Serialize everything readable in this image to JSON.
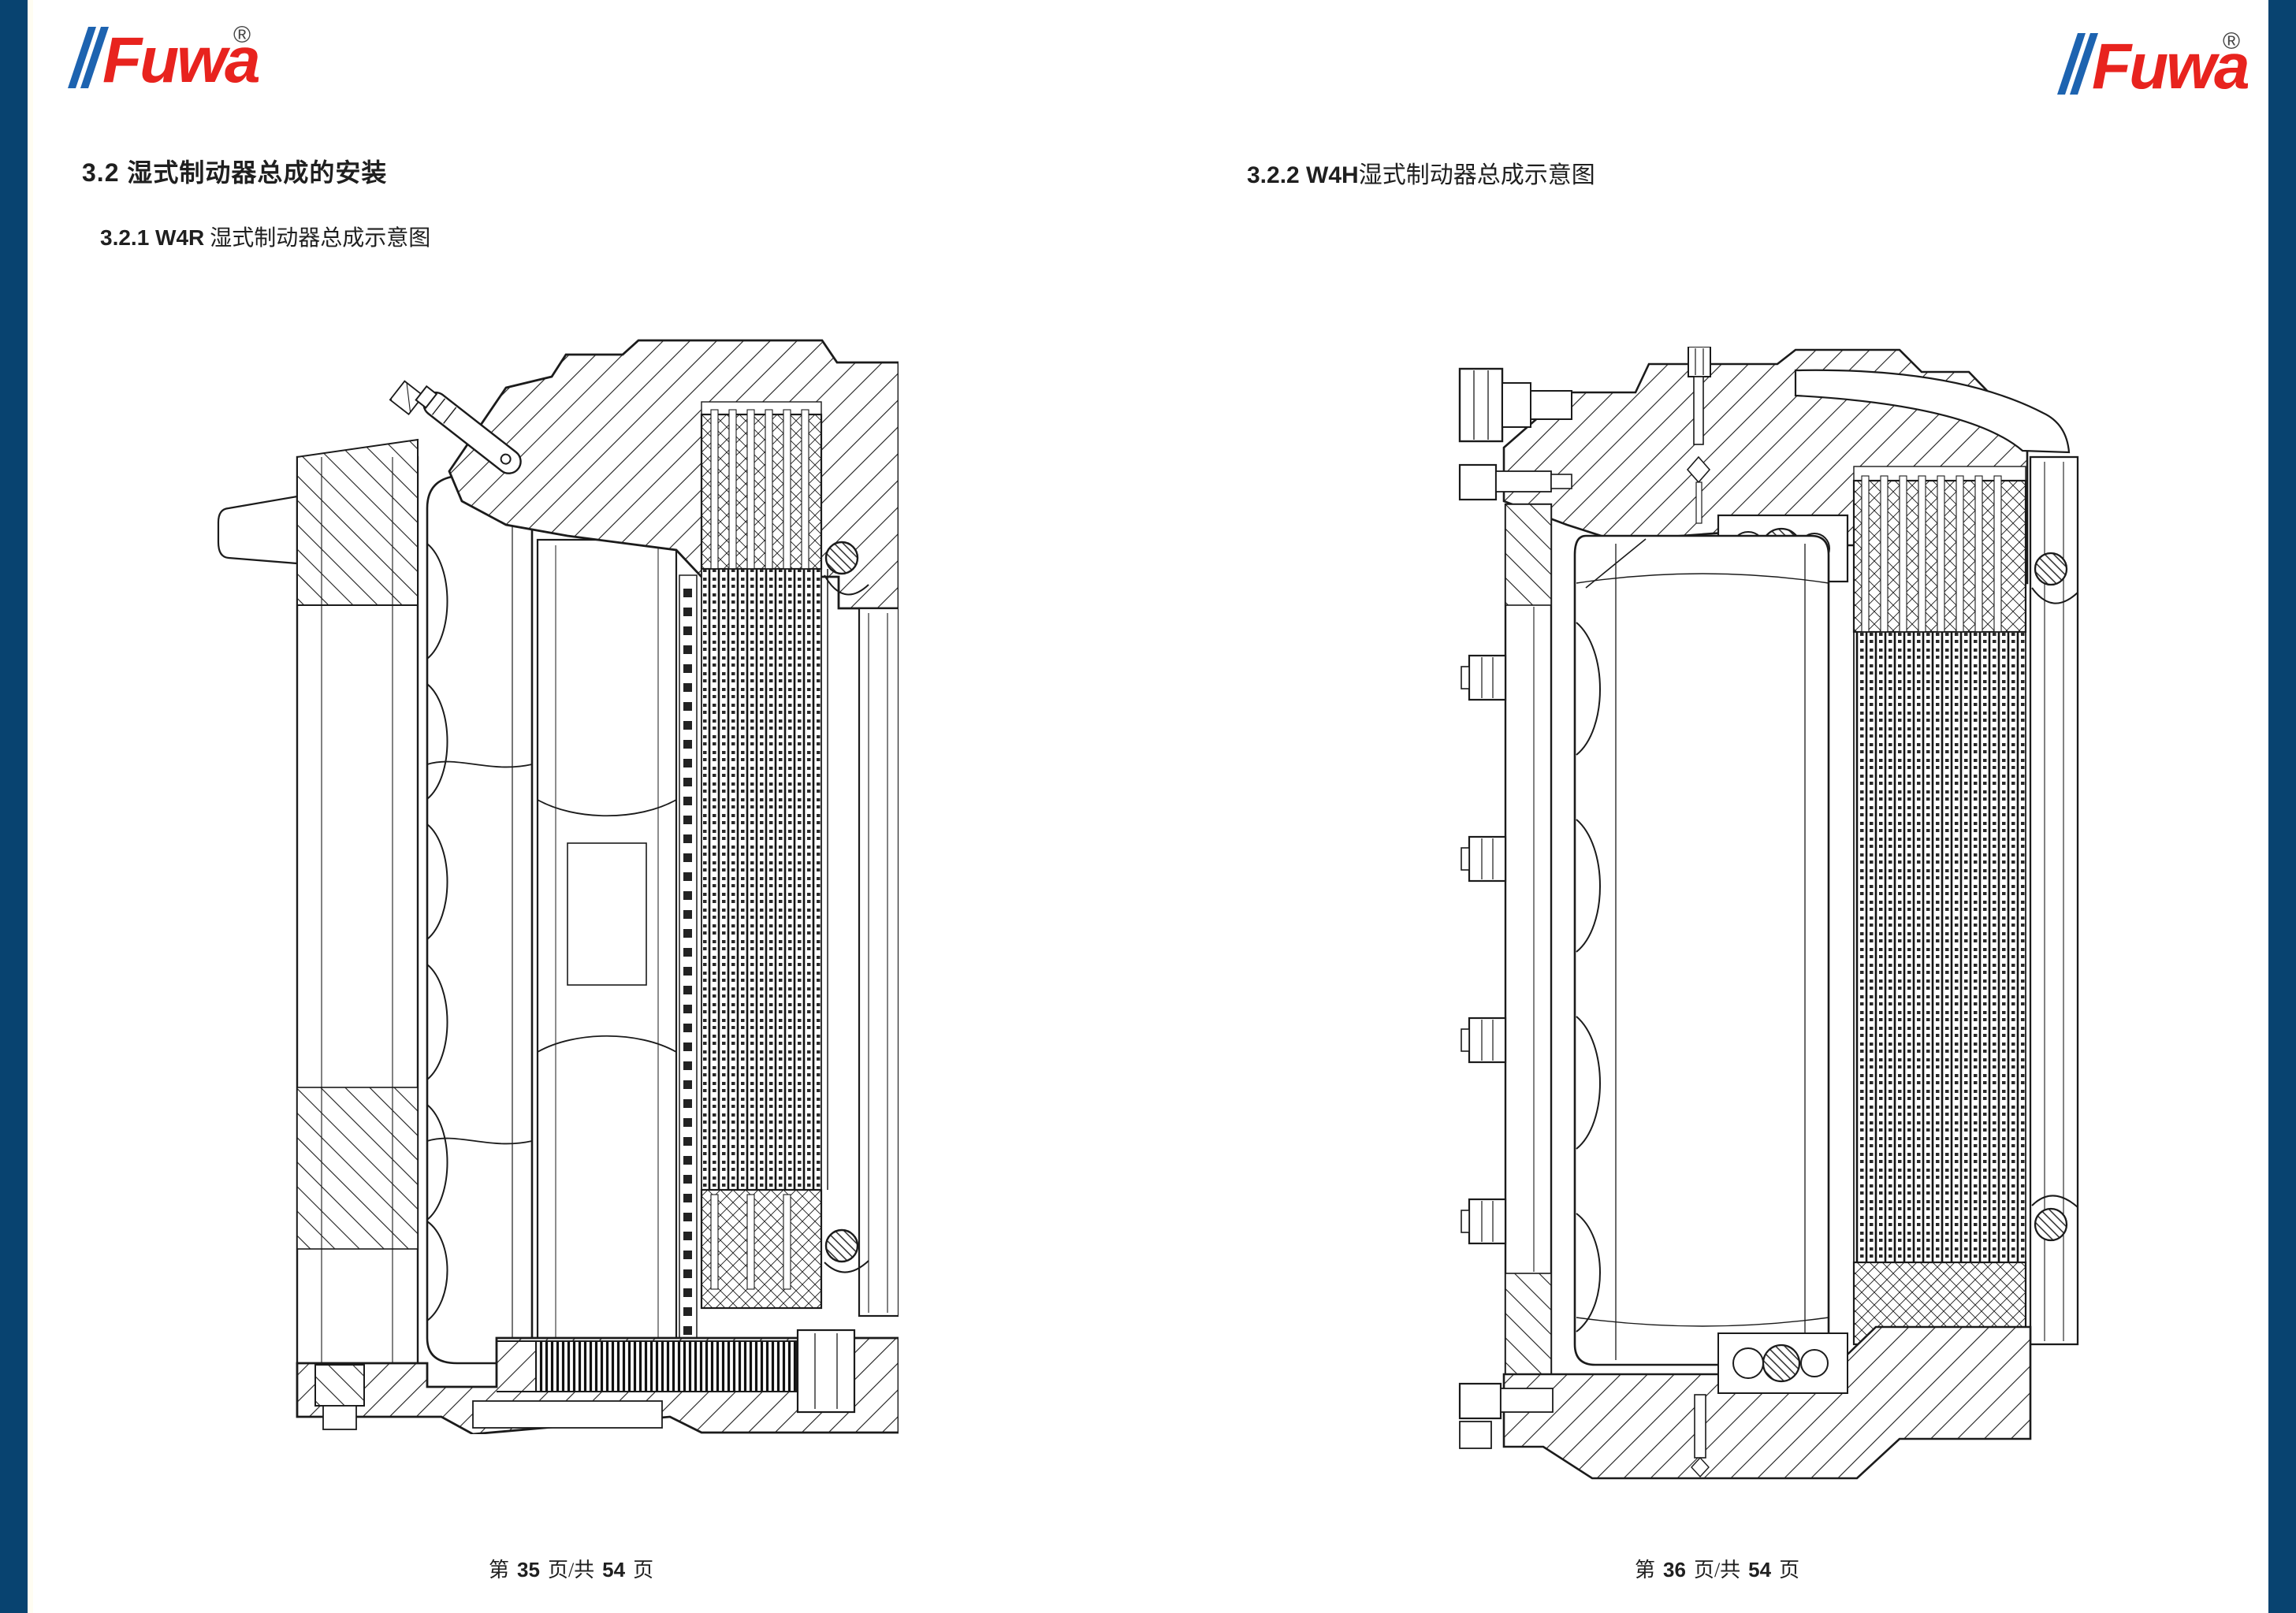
{
  "page": {
    "background": "#ffffff",
    "accent_bar_color": "#084370"
  },
  "logo": {
    "text": "Fuwa",
    "registered": "®",
    "red": "#e8231e",
    "blue": "#1d63b0"
  },
  "left_page": {
    "heading1": "3.2  湿式制动器总成的安装",
    "heading2": {
      "num": "3.2.1 W4R",
      "zh": " 湿式制动器总成示意图"
    },
    "footer": {
      "prefix": "第",
      "page_num": "35",
      "middle": "页/共",
      "total": "54",
      "suffix": "页"
    }
  },
  "right_page": {
    "heading": {
      "num": "3.2.2 W4H",
      "zh": "湿式制动器总成示意图"
    },
    "footer": {
      "prefix": "第",
      "page_num": "36",
      "middle": "页/共",
      "total": "54",
      "suffix": "页"
    }
  }
}
